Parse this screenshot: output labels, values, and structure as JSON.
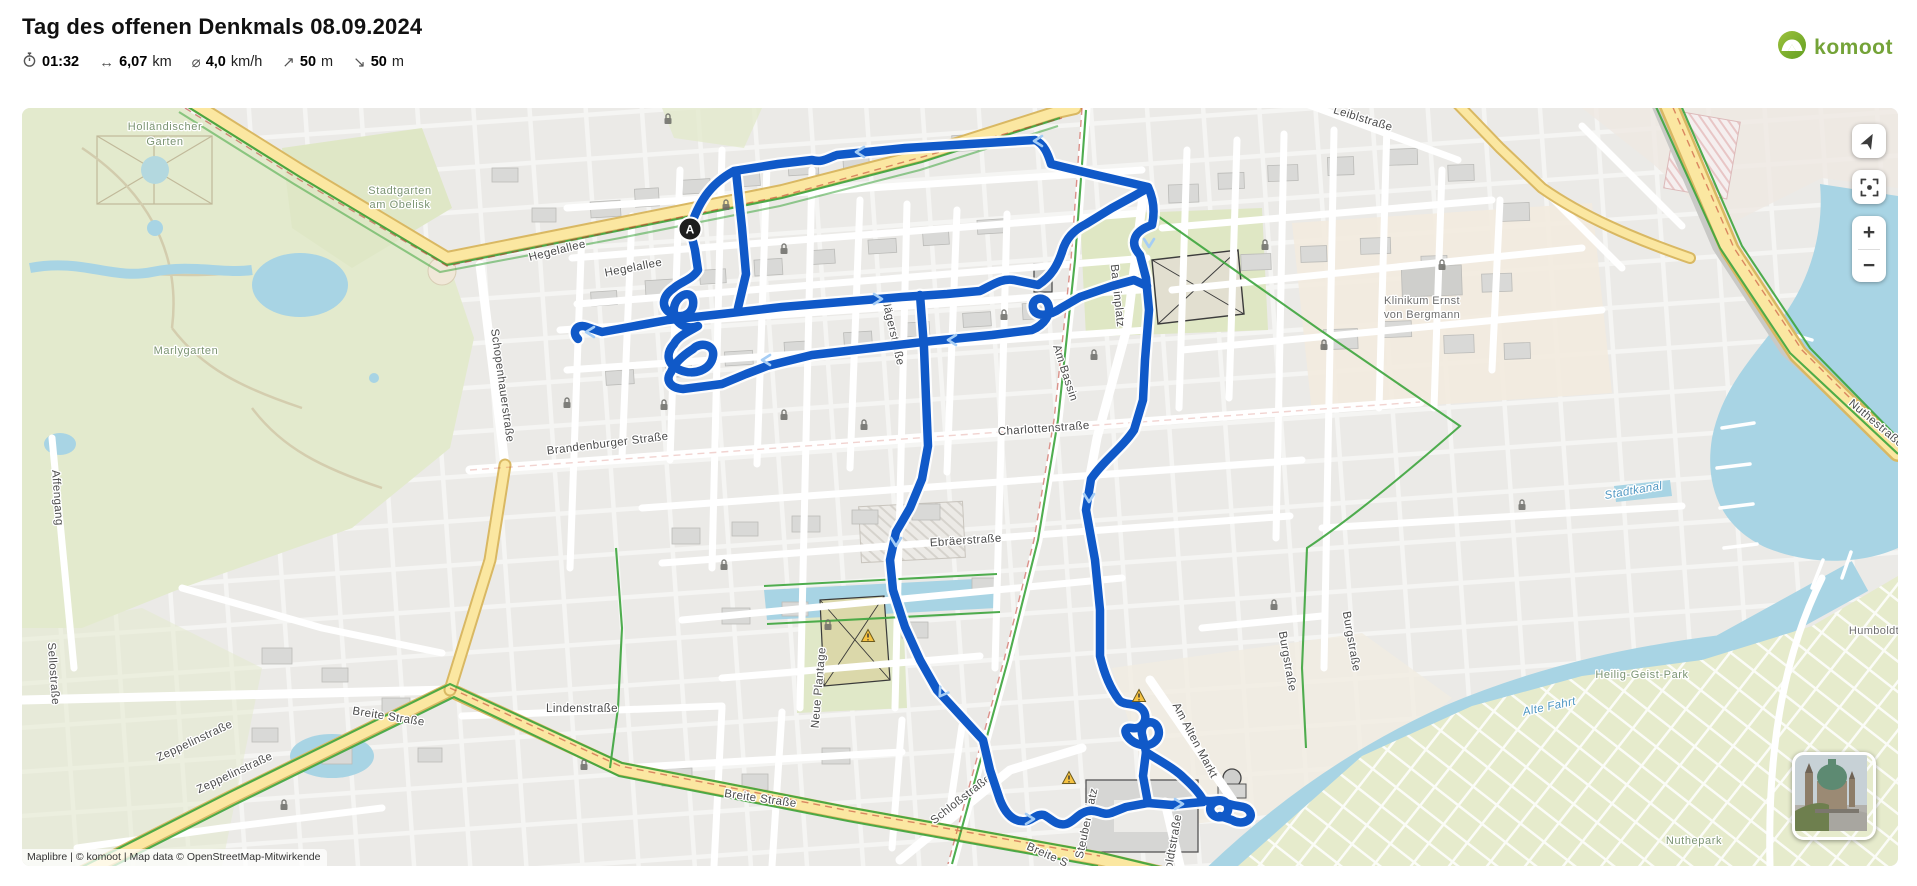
{
  "header": {
    "title": "Tag des offenen Denkmals 08.09.2024",
    "stats": [
      {
        "name": "duration",
        "glyph": "",
        "value": "01:32",
        "unit": ""
      },
      {
        "name": "distance",
        "glyph": "↔",
        "value": "6,07",
        "unit": "km"
      },
      {
        "name": "avg-speed",
        "glyph": "⌀",
        "value": "4,0",
        "unit": "km/h"
      },
      {
        "name": "ascent",
        "glyph": "↗",
        "value": "50",
        "unit": "m"
      },
      {
        "name": "descent",
        "glyph": "↘",
        "value": "50",
        "unit": "m"
      }
    ],
    "brand": "komoot"
  },
  "map": {
    "attribution": "Maplibre | © komoot | Map data © OpenStreetMap-Mitwirkende",
    "start_marker": "A",
    "controls": {
      "zoom_in": "+",
      "zoom_out": "−"
    },
    "labels": [
      {
        "text": "Holländischer",
        "x": 143,
        "y": 22,
        "rot": 0,
        "cls": "park"
      },
      {
        "text": "Garten",
        "x": 143,
        "y": 37,
        "rot": 0,
        "cls": "park"
      },
      {
        "text": "Stadtgarten",
        "x": 378,
        "y": 86,
        "rot": 0,
        "cls": "park"
      },
      {
        "text": "am Obelisk",
        "x": 378,
        "y": 100,
        "rot": 0,
        "cls": "park"
      },
      {
        "text": "Marlygarten",
        "x": 164,
        "y": 246,
        "rot": 0,
        "cls": "park"
      },
      {
        "text": "Hegelallee",
        "x": 536,
        "y": 146,
        "rot": -14,
        "cls": "street"
      },
      {
        "text": "Hegelallee",
        "x": 612,
        "y": 163,
        "rot": -11,
        "cls": "street"
      },
      {
        "text": "Leiblstraße",
        "x": 1340,
        "y": 14,
        "rot": 17,
        "cls": "street"
      },
      {
        "text": "Jägerstraße",
        "x": 868,
        "y": 226,
        "rot": 77,
        "cls": "street"
      },
      {
        "text": "Bassinplatz",
        "x": 1092,
        "y": 188,
        "rot": 84,
        "cls": "street"
      },
      {
        "text": "Am Bassin",
        "x": 1040,
        "y": 266,
        "rot": 72,
        "cls": "street"
      },
      {
        "text": "Charlottenstraße",
        "x": 1022,
        "y": 324,
        "rot": -4,
        "cls": "street"
      },
      {
        "text": "Brandenburger Straße",
        "x": 586,
        "y": 339,
        "rot": -7,
        "cls": "street"
      },
      {
        "text": "Schopenhauerstraße",
        "x": 477,
        "y": 278,
        "rot": 82,
        "cls": "street"
      },
      {
        "text": "Affengang",
        "x": 32,
        "y": 390,
        "rot": 86,
        "cls": "street"
      },
      {
        "text": "Sellostraße",
        "x": 28,
        "y": 566,
        "rot": 86,
        "cls": "street"
      },
      {
        "text": "Zeppelinstraße",
        "x": 174,
        "y": 636,
        "rot": -25,
        "cls": "street"
      },
      {
        "text": "Zeppelinstraße",
        "x": 214,
        "y": 668,
        "rot": -25,
        "cls": "street"
      },
      {
        "text": "Breite Straße",
        "x": 366,
        "y": 612,
        "rot": 9,
        "cls": "street"
      },
      {
        "text": "Lindenstraße",
        "x": 560,
        "y": 604,
        "rot": 0,
        "cls": "street"
      },
      {
        "text": "Neue Plantage",
        "x": 800,
        "y": 580,
        "rot": -85,
        "cls": "street"
      },
      {
        "text": "Ebräerstraße",
        "x": 944,
        "y": 436,
        "rot": -4,
        "cls": "street"
      },
      {
        "text": "Breite Straße",
        "x": 738,
        "y": 694,
        "rot": 8,
        "cls": "street"
      },
      {
        "text": "Breite S",
        "x": 1024,
        "y": 750,
        "rot": 24,
        "cls": "street"
      },
      {
        "text": "Schloßstraße",
        "x": 941,
        "y": 694,
        "rot": -38,
        "cls": "street"
      },
      {
        "text": "Steubenplatz",
        "x": 1068,
        "y": 716,
        "rot": -78,
        "cls": "street"
      },
      {
        "text": "Humboldtstraße",
        "x": 1152,
        "y": 750,
        "rot": -80,
        "cls": "street"
      },
      {
        "text": "Am Alten Markt",
        "x": 1170,
        "y": 634,
        "rot": 62,
        "cls": "street"
      },
      {
        "text": "Burgstraße",
        "x": 1262,
        "y": 554,
        "rot": 80,
        "cls": "street"
      },
      {
        "text": "Burgstraße",
        "x": 1326,
        "y": 534,
        "rot": 80,
        "cls": "street"
      },
      {
        "text": "Nuthestraße",
        "x": 1852,
        "y": 318,
        "rot": 40,
        "cls": "street"
      },
      {
        "text": "Klinikum Ernst",
        "x": 1400,
        "y": 196,
        "rot": 0,
        "cls": "place"
      },
      {
        "text": "von Bergmann",
        "x": 1400,
        "y": 210,
        "rot": 0,
        "cls": "place"
      },
      {
        "text": "Heilig-Geist-Park",
        "x": 1620,
        "y": 570,
        "rot": 0,
        "cls": "park"
      },
      {
        "text": "Humboldt",
        "x": 1852,
        "y": 526,
        "rot": 0,
        "cls": "place"
      },
      {
        "text": "Nuthepark",
        "x": 1672,
        "y": 736,
        "rot": 0,
        "cls": "park"
      },
      {
        "text": "Stadtkanal",
        "x": 1612,
        "y": 386,
        "rot": -10,
        "cls": "water"
      },
      {
        "text": "Alte Fahrt",
        "x": 1528,
        "y": 602,
        "rot": -12,
        "cls": "water"
      }
    ]
  },
  "colors": {
    "route": "#1059c8",
    "route-arrow": "#a5cdf5",
    "brand-green": "#74a338",
    "road-yellow": "#fbe7a1",
    "water": "#a8d4e4",
    "park": "#e3eacd",
    "bike-green": "#3da53d",
    "urban": "#ebeae7"
  }
}
